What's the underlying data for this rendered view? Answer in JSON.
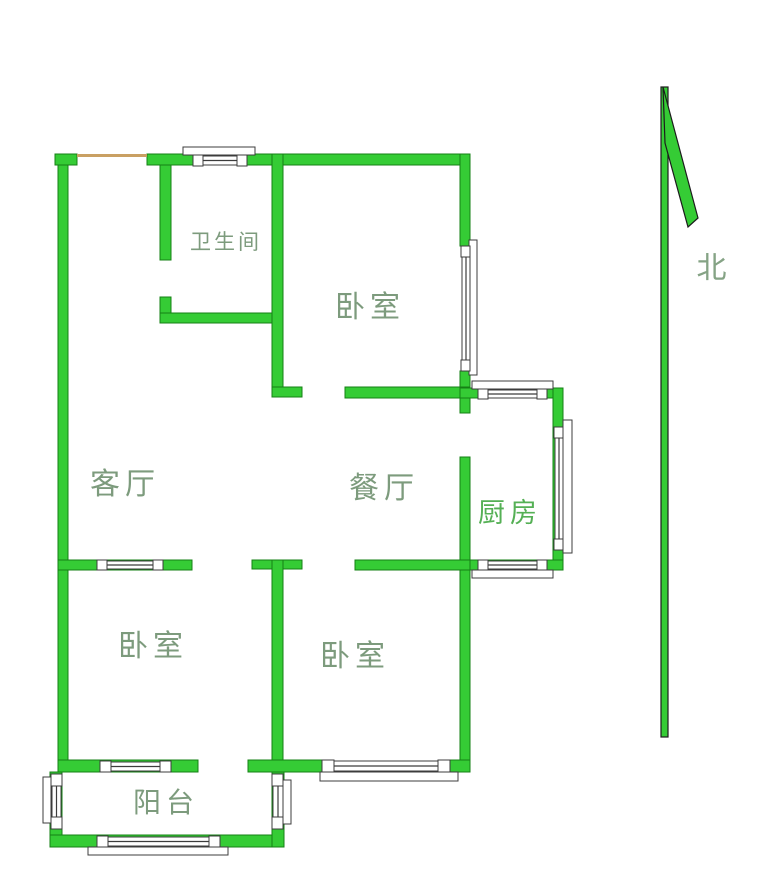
{
  "colors": {
    "wall_fill": "#35cc35",
    "wall_outline": "#158015",
    "window_fill": "#ffffff",
    "window_stroke": "#3c3c3c",
    "entry_line": "#c9a063",
    "label_color": "#7d9b7d",
    "kitchen_label_color": "#55b055",
    "north_label_color": "#85a385",
    "arrow_fill": "#35cc35",
    "arrow_outline": "#1c1c1c",
    "background": "#ffffff"
  },
  "rooms": {
    "bathroom": {
      "label": "卫生间"
    },
    "bedroom_top": {
      "label": "卧室"
    },
    "living_room": {
      "label": "客厅"
    },
    "dining_room": {
      "label": "餐厅"
    },
    "kitchen": {
      "label": "厨房"
    },
    "bedroom_left": {
      "label": "卧室"
    },
    "bedroom_middle": {
      "label": "卧室"
    },
    "balcony": {
      "label": "阳台"
    }
  },
  "compass": {
    "north_label": "北"
  }
}
